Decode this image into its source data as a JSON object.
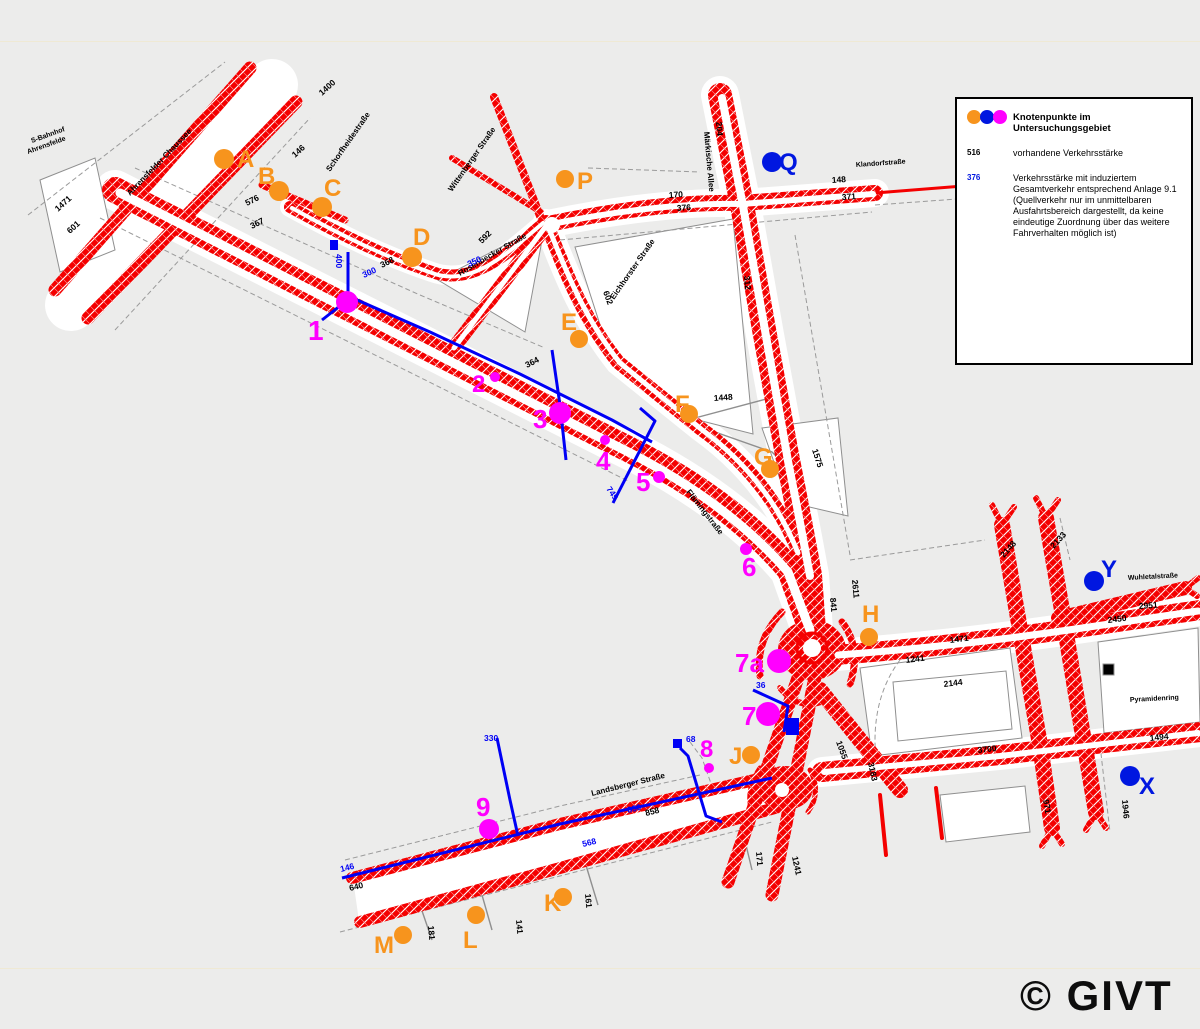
{
  "page": {
    "copyright": "© GIVT"
  },
  "colors": {
    "orange": "#F7941D",
    "magenta": "#FF00FF",
    "blue": "#0017E0",
    "red": "#F40000",
    "line_blue": "#0000F5",
    "black": "#000000"
  },
  "legend": {
    "title": "Knotenpunkte im Untersuchungsgebiet",
    "existing_sample": "516",
    "existing_text": "vorhandene Verkehrsstärke",
    "induced_sample": "376",
    "induced_lines": [
      "Verkehrsstärke mit induziertem",
      "Gesamtverkehr entsprechend Anlage 9.1",
      "(Quellverkehr nur im unmittelbaren",
      "Ausfahrtsbereich dargestellt, da keine",
      "eindeutige Zuordnung über das weitere",
      "Fahrverhalten möglich ist)"
    ]
  },
  "markers": [
    {
      "id": "A",
      "label": "A",
      "color": "orange",
      "cx": 224,
      "cy": 159,
      "r": 10,
      "lx": 237,
      "ly": 167,
      "fs": 24
    },
    {
      "id": "B",
      "label": "B",
      "color": "orange",
      "cx": 279,
      "cy": 191,
      "r": 10,
      "lx": 258,
      "ly": 184,
      "fs": 24
    },
    {
      "id": "C",
      "label": "C",
      "color": "orange",
      "cx": 322,
      "cy": 207,
      "r": 10,
      "lx": 324,
      "ly": 196,
      "fs": 24
    },
    {
      "id": "D",
      "label": "D",
      "color": "orange",
      "cx": 412,
      "cy": 257,
      "r": 10,
      "lx": 413,
      "ly": 245,
      "fs": 24
    },
    {
      "id": "E",
      "label": "E",
      "color": "orange",
      "cx": 579,
      "cy": 339,
      "r": 9,
      "lx": 561,
      "ly": 330,
      "fs": 24
    },
    {
      "id": "F",
      "label": "F",
      "color": "orange",
      "cx": 689,
      "cy": 414,
      "r": 9,
      "lx": 675,
      "ly": 412,
      "fs": 24
    },
    {
      "id": "G",
      "label": "G",
      "color": "orange",
      "cx": 770,
      "cy": 469,
      "r": 9,
      "lx": 754,
      "ly": 465,
      "fs": 24
    },
    {
      "id": "H",
      "label": "H",
      "color": "orange",
      "cx": 869,
      "cy": 637,
      "r": 9,
      "lx": 862,
      "ly": 622,
      "fs": 24
    },
    {
      "id": "J",
      "label": "J",
      "color": "orange",
      "cx": 751,
      "cy": 755,
      "r": 9,
      "lx": 729,
      "ly": 764,
      "fs": 24
    },
    {
      "id": "K",
      "label": "K",
      "color": "orange",
      "cx": 563,
      "cy": 897,
      "r": 9,
      "lx": 544,
      "ly": 911,
      "fs": 24
    },
    {
      "id": "L",
      "label": "L",
      "color": "orange",
      "cx": 476,
      "cy": 915,
      "r": 9,
      "lx": 463,
      "ly": 948,
      "fs": 24
    },
    {
      "id": "M",
      "label": "M",
      "color": "orange",
      "cx": 403,
      "cy": 935,
      "r": 9,
      "lx": 374,
      "ly": 953,
      "fs": 24
    },
    {
      "id": "P",
      "label": "P",
      "color": "orange",
      "cx": 565,
      "cy": 179,
      "r": 9,
      "lx": 577,
      "ly": 189,
      "fs": 24
    },
    {
      "id": "Q",
      "label": "Q",
      "color": "blue",
      "cx": 772,
      "cy": 162,
      "r": 10,
      "lx": 779,
      "ly": 170,
      "fs": 24
    },
    {
      "id": "X",
      "label": "X",
      "color": "blue",
      "cx": 1130,
      "cy": 776,
      "r": 10,
      "lx": 1139,
      "ly": 794,
      "fs": 24
    },
    {
      "id": "Y",
      "label": "Y",
      "color": "blue",
      "cx": 1094,
      "cy": 581,
      "r": 10,
      "lx": 1101,
      "ly": 577,
      "fs": 24
    },
    {
      "id": "1",
      "label": "1",
      "color": "magenta",
      "cx": 347,
      "cy": 302,
      "r": 11,
      "lx": 308,
      "ly": 340,
      "fs": 28
    },
    {
      "id": "2",
      "label": "2",
      "color": "magenta",
      "cx": 495,
      "cy": 377,
      "r": 5,
      "lx": 472,
      "ly": 392,
      "fs": 24
    },
    {
      "id": "3",
      "label": "3",
      "color": "magenta",
      "cx": 560,
      "cy": 413,
      "r": 11,
      "lx": 533,
      "ly": 428,
      "fs": 26
    },
    {
      "id": "4",
      "label": "4",
      "color": "magenta",
      "cx": 605,
      "cy": 440,
      "r": 5,
      "lx": 596,
      "ly": 470,
      "fs": 26
    },
    {
      "id": "5",
      "label": "5",
      "color": "magenta",
      "cx": 659,
      "cy": 477,
      "r": 6,
      "lx": 636,
      "ly": 491,
      "fs": 26
    },
    {
      "id": "6",
      "label": "6",
      "color": "magenta",
      "cx": 746,
      "cy": 549,
      "r": 6,
      "lx": 742,
      "ly": 576,
      "fs": 26
    },
    {
      "id": "7a",
      "label": "7a",
      "color": "magenta",
      "cx": 779,
      "cy": 661,
      "r": 12,
      "lx": 735,
      "ly": 672,
      "fs": 26
    },
    {
      "id": "7",
      "label": "7",
      "color": "magenta",
      "cx": 768,
      "cy": 714,
      "r": 12,
      "lx": 742,
      "ly": 725,
      "fs": 26
    },
    {
      "id": "8",
      "label": "8",
      "color": "magenta",
      "cx": 709,
      "cy": 768,
      "r": 5,
      "lx": 700,
      "ly": 757,
      "fs": 24
    },
    {
      "id": "9",
      "label": "9",
      "color": "magenta",
      "cx": 489,
      "cy": 829,
      "r": 10,
      "lx": 476,
      "ly": 816,
      "fs": 26
    }
  ],
  "road_labels": [
    {
      "t": "1400",
      "x": 322,
      "y": 96,
      "rot": -42,
      "c": "black"
    },
    {
      "t": "146",
      "x": 295,
      "y": 158,
      "rot": -42,
      "c": "black"
    },
    {
      "t": "1471",
      "x": 58,
      "y": 212,
      "rot": -42,
      "c": "black"
    },
    {
      "t": "601",
      "x": 70,
      "y": 234,
      "rot": -42,
      "c": "black"
    },
    {
      "t": "576",
      "x": 247,
      "y": 206,
      "rot": -27,
      "c": "black"
    },
    {
      "t": "367",
      "x": 252,
      "y": 229,
      "rot": -27,
      "c": "black"
    },
    {
      "t": "368",
      "x": 382,
      "y": 268,
      "rot": -27,
      "c": "black"
    },
    {
      "t": "364",
      "x": 527,
      "y": 368,
      "rot": -27,
      "c": "black"
    },
    {
      "t": "592",
      "x": 482,
      "y": 244,
      "rot": -45,
      "c": "black"
    },
    {
      "t": "602",
      "x": 603,
      "y": 292,
      "rot": 70,
      "c": "black"
    },
    {
      "t": "312",
      "x": 744,
      "y": 276,
      "rot": 85,
      "c": "black"
    },
    {
      "t": "204",
      "x": 716,
      "y": 122,
      "rot": 85,
      "c": "black"
    },
    {
      "t": "170",
      "x": 669,
      "y": 198,
      "rot": -4,
      "c": "black"
    },
    {
      "t": "376",
      "x": 677,
      "y": 211,
      "rot": -4,
      "c": "black"
    },
    {
      "t": "148",
      "x": 832,
      "y": 183,
      "rot": -4,
      "c": "black"
    },
    {
      "t": "371",
      "x": 842,
      "y": 200,
      "rot": -4,
      "c": "black"
    },
    {
      "t": "1448",
      "x": 714,
      "y": 401,
      "rot": -4,
      "c": "black"
    },
    {
      "t": "841",
      "x": 830,
      "y": 598,
      "rot": 85,
      "c": "black"
    },
    {
      "t": "2611",
      "x": 852,
      "y": 580,
      "rot": 85,
      "c": "black"
    },
    {
      "t": "1575",
      "x": 812,
      "y": 450,
      "rot": 72,
      "c": "black"
    },
    {
      "t": "1471",
      "x": 950,
      "y": 643,
      "rot": -7,
      "c": "black"
    },
    {
      "t": "1241",
      "x": 906,
      "y": 663,
      "rot": -7,
      "c": "black"
    },
    {
      "t": "2144",
      "x": 944,
      "y": 687,
      "rot": -7,
      "c": "black"
    },
    {
      "t": "3183",
      "x": 868,
      "y": 763,
      "rot": 78,
      "c": "black"
    },
    {
      "t": "2450",
      "x": 1108,
      "y": 623,
      "rot": -7,
      "c": "black"
    },
    {
      "t": "2148",
      "x": 1004,
      "y": 558,
      "rot": -48,
      "c": "black"
    },
    {
      "t": "2133",
      "x": 1054,
      "y": 549,
      "rot": -48,
      "c": "black"
    },
    {
      "t": "2951",
      "x": 1139,
      "y": 609,
      "rot": -4,
      "c": "black"
    },
    {
      "t": "3700",
      "x": 978,
      "y": 753,
      "rot": -6,
      "c": "black"
    },
    {
      "t": "1494",
      "x": 1150,
      "y": 741,
      "rot": -6,
      "c": "black"
    },
    {
      "t": "1946",
      "x": 1122,
      "y": 800,
      "rot": 85,
      "c": "black"
    },
    {
      "t": "971",
      "x": 1043,
      "y": 800,
      "rot": 80,
      "c": "black"
    },
    {
      "t": "1241",
      "x": 792,
      "y": 857,
      "rot": 78,
      "c": "black"
    },
    {
      "t": "1055",
      "x": 836,
      "y": 742,
      "rot": 70,
      "c": "black"
    },
    {
      "t": "858",
      "x": 646,
      "y": 816,
      "rot": -14,
      "c": "black"
    },
    {
      "t": "640",
      "x": 350,
      "y": 891,
      "rot": -14,
      "c": "black"
    },
    {
      "t": "181",
      "x": 428,
      "y": 926,
      "rot": 85,
      "c": "black"
    },
    {
      "t": "141",
      "x": 516,
      "y": 920,
      "rot": 85,
      "c": "black"
    },
    {
      "t": "161",
      "x": 585,
      "y": 894,
      "rot": 85,
      "c": "black"
    },
    {
      "t": "171",
      "x": 756,
      "y": 852,
      "rot": 85,
      "c": "black"
    },
    {
      "t": "400",
      "x": 336,
      "y": 254,
      "rot": 90,
      "c": "blue"
    },
    {
      "t": "300",
      "x": 364,
      "y": 278,
      "rot": -25,
      "c": "blue"
    },
    {
      "t": "350",
      "x": 469,
      "y": 267,
      "rot": -25,
      "c": "blue"
    },
    {
      "t": "749",
      "x": 606,
      "y": 489,
      "rot": 55,
      "c": "blue"
    },
    {
      "t": "330",
      "x": 484,
      "y": 741,
      "rot": 0,
      "c": "blue"
    },
    {
      "t": "68",
      "x": 686,
      "y": 742,
      "rot": 0,
      "c": "blue"
    },
    {
      "t": "36",
      "x": 756,
      "y": 688,
      "rot": 0,
      "c": "blue"
    },
    {
      "t": "850",
      "x": 628,
      "y": 813,
      "rot": -14,
      "c": "blue"
    },
    {
      "t": "568",
      "x": 583,
      "y": 847,
      "rot": -14,
      "c": "blue"
    },
    {
      "t": "146",
      "x": 341,
      "y": 872,
      "rot": -14,
      "c": "blue"
    }
  ],
  "street_labels": [
    {
      "t": "S-Bahnhof",
      "x": 32,
      "y": 143,
      "rot": -20,
      "fs": 7
    },
    {
      "t": "Ahrensfelde",
      "x": 28,
      "y": 154,
      "rot": -20,
      "fs": 7
    },
    {
      "t": "Ahrensfelder Chaussee",
      "x": 130,
      "y": 196,
      "rot": -46,
      "fs": 8
    },
    {
      "t": "Schorfheidestraße",
      "x": 330,
      "y": 172,
      "rot": -55,
      "fs": 8
    },
    {
      "t": "Wittenberger Straße",
      "x": 452,
      "y": 192,
      "rot": -55,
      "fs": 8
    },
    {
      "t": "Rosenbecker Straße",
      "x": 460,
      "y": 276,
      "rot": -30,
      "fs": 8
    },
    {
      "t": "Märkische Allee",
      "x": 704,
      "y": 132,
      "rot": 85,
      "fs": 8
    },
    {
      "t": "Klandorfstraße",
      "x": 856,
      "y": 167,
      "rot": -4,
      "fs": 7
    },
    {
      "t": "Eichhorster Straße",
      "x": 614,
      "y": 300,
      "rot": -55,
      "fs": 8
    },
    {
      "t": "Flämingstraße",
      "x": 686,
      "y": 492,
      "rot": 52,
      "fs": 8
    },
    {
      "t": "Landsberger Straße",
      "x": 592,
      "y": 796,
      "rot": -14,
      "fs": 8
    },
    {
      "t": "Wuhletalstraße",
      "x": 1128,
      "y": 580,
      "rot": -3,
      "fs": 7
    },
    {
      "t": "Pyramidenring",
      "x": 1130,
      "y": 702,
      "rot": -3,
      "fs": 7
    }
  ]
}
